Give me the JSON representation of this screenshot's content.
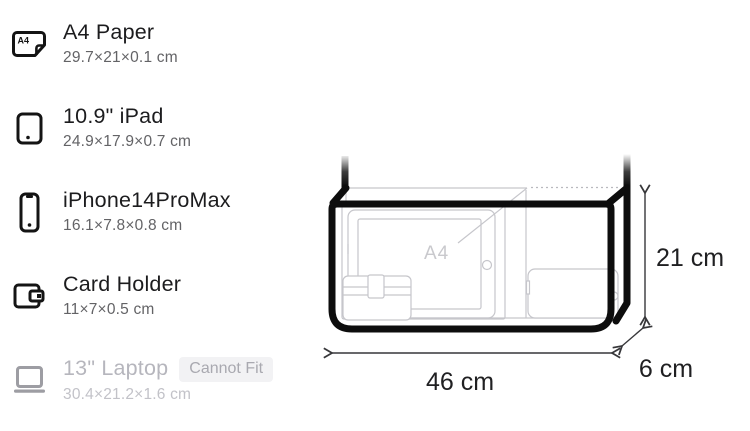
{
  "list": {
    "items": [
      {
        "title": "A4 Paper",
        "dims": "29.7×21×0.1 cm"
      },
      {
        "title": "10.9\" iPad",
        "dims": "24.9×17.9×0.7 cm"
      },
      {
        "title": "iPhone14ProMax",
        "dims": "16.1×7.8×0.8 cm"
      },
      {
        "title": "Card Holder",
        "dims": "11×7×0.5 cm"
      },
      {
        "title": "13\" Laptop",
        "dims": "30.4×21.2×1.6 cm",
        "badge": "Cannot Fit"
      }
    ]
  },
  "diagram": {
    "width_label": "46 cm",
    "height_label": "21 cm",
    "depth_label": "6 cm",
    "content_label": "A4"
  },
  "colors": {
    "title_text": "#1c1c1e",
    "subtitle_text": "#636366",
    "disabled_text": "#b6b6bd",
    "badge_bg": "#f2f2f4",
    "badge_text": "#a9a9b0",
    "bag_outline": "#0d0d0d",
    "item_outline_light": "#c6c6cb",
    "dimension_text": "#202022"
  }
}
